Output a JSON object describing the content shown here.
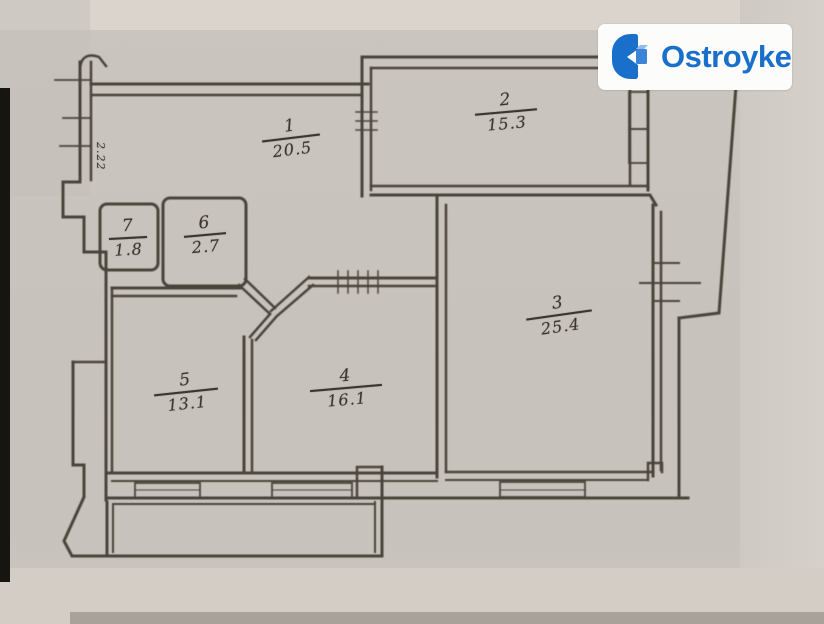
{
  "scan": {
    "rooms": [
      {
        "number": "1",
        "area": "20.5"
      },
      {
        "number": "2",
        "area": "15.3"
      },
      {
        "number": "3",
        "area": "25.4"
      },
      {
        "number": "4",
        "area": "16.1"
      },
      {
        "number": "5",
        "area": "13.1"
      },
      {
        "number": "6",
        "area": "2.7"
      },
      {
        "number": "7",
        "area": "1.8"
      }
    ],
    "dimension_note": "2.22"
  },
  "logo": {
    "text": "Ostroyke"
  },
  "colors": {
    "brand_blue": "#1a6fcb",
    "wall_ink": "#4a443b",
    "paper": "#cac4be",
    "logo_bg": "#fcfcfb"
  }
}
